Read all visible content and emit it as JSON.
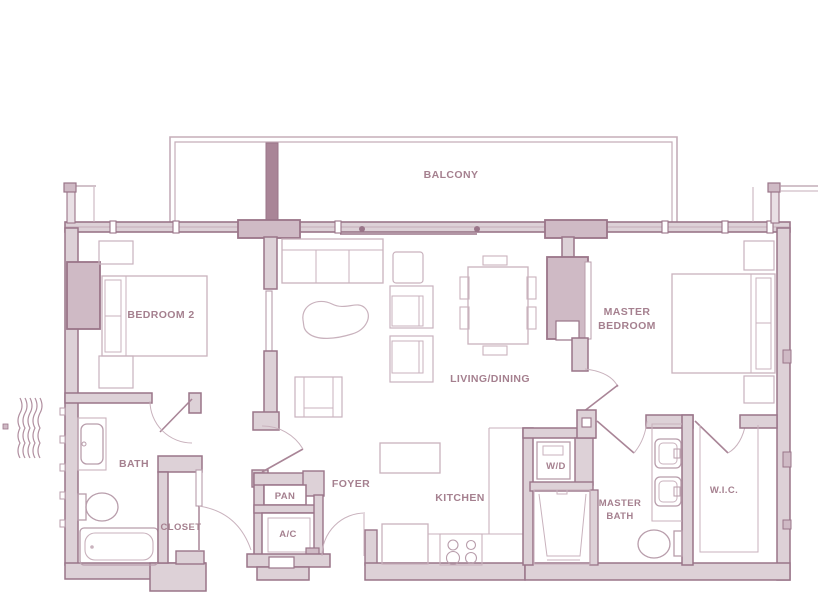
{
  "plan_title": "Two-bedroom apartment floor plan",
  "rooms": {
    "balcony": {
      "label": "BALCONY"
    },
    "bedroom2": {
      "label": "BEDROOM 2"
    },
    "living_dining": {
      "label": "LIVING/DINING"
    },
    "master_bedroom": {
      "line1": "MASTER",
      "line2": "BEDROOM"
    },
    "bath": {
      "label": "BATH"
    },
    "closet": {
      "label": "CLOSET"
    },
    "pantry": {
      "label": "PAN"
    },
    "ac_closet": {
      "label": "A/C"
    },
    "foyer": {
      "label": "FOYER"
    },
    "kitchen": {
      "label": "KITCHEN"
    },
    "laundry": {
      "label": "W/D"
    },
    "master_bath": {
      "line1": "MASTER",
      "line2": "BATH"
    },
    "wic": {
      "label": "W.I.C."
    }
  },
  "fixtures": [
    "sofa",
    "coffee-table",
    "armchair",
    "dining-table",
    "dining-chair",
    "bed",
    "nightstand",
    "bathtub",
    "toilet",
    "sink",
    "vanity",
    "shower",
    "washer-dryer",
    "stove",
    "kitchen-island",
    "refrigerator",
    "sliding-door",
    "swing-door",
    "window-wall",
    "balcony-rail",
    "water-symbol"
  ],
  "colors": {
    "wall_stroke": "#9a7589",
    "wall_fill": "#ddd1d7",
    "column_fill": "#cfbac5",
    "solid_wall": "#a98597",
    "furniture_stroke": "#c9b2bd",
    "fixture_stroke": "#b89dab",
    "label_text": "#a5808f",
    "background": "#ffffff"
  }
}
